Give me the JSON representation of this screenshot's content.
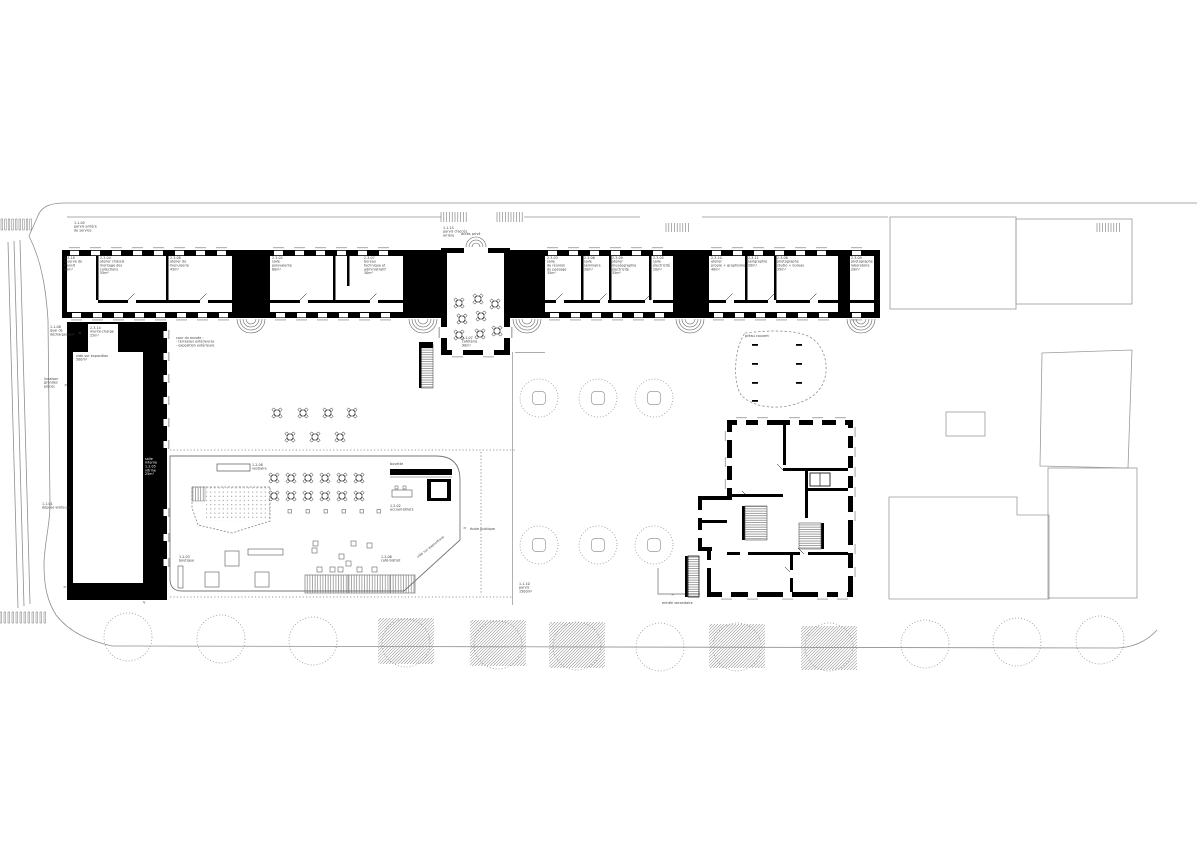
{
  "colors": {
    "ink": "#000000",
    "siteline": "#8f8f8f",
    "label": "#3a3a3a",
    "sill": "#b5b5b5"
  },
  "labels": {
    "parvis_arriere": "1.1.05\nparvis arrière\nde service",
    "acces_arriere": "1.1.14\nparvis d'accès\narrière",
    "acces_prive": "accès privé",
    "quai": "1.1.08\nquai de\ndéchargement",
    "monte_charge": "2.3.14\nmonte-charge\n25m²",
    "vide_expo": "vide sur exposition\n500m²",
    "livraison": "livraison\ngrandes\npièces",
    "depose": "1.1.01\ndépose-visiteurs",
    "galerie": "salle\ninterne\n1.2.05\nvitrine\n25m²",
    "cour": "cour du musée :\n- terrasses extérieures\n- exposition extérieure",
    "cafeteria": "2.1.07\ncafétéria\n90m²",
    "vestiaire": "1.2.08\nvestiaire",
    "buvette": "buvette",
    "accueil": "1.2.02\naccueil-billets",
    "boutique": "1.2.03\nboutique",
    "cafe_bistrot": "1.2.06\ncafé-bistrot",
    "vide_expos2": "vide sur expositions",
    "ecole": "école publique",
    "parvis": "1.1.10\nparvis\n1500m²",
    "entree_sec": "entrée secondaire",
    "preau": "préau couvert"
  },
  "arrows": {
    "right": ">",
    "left": "<",
    "up": "^",
    "down": "v"
  },
  "rooms": [
    "2.3.18\nréserve de\ntransit\n30m²",
    "2.3.04\natelier châssis\nmontage des\ncollections\n55m²",
    "2.3.08\natelier de\nmenuiserie\n45m²",
    "2.3.02\nsalle\npolyvalente\n60m²",
    "2.3.07\nbureau\ntechnique et\nadministratif\n30m²",
    "2.3.03\nsalle\nde réunion\ndu passage\n35m²",
    "2.3.06\nsalle\nséminaire\n20m²",
    "2.3.09\natelier\nmuséographie\nélectricité\n35m²",
    "2.3.05\nsalle\nélectricité\n20m²",
    "2.3.10\natelier\npropre + graphisme\n40m²",
    "2.3.11\nsérigraphie\n20m²",
    "2.3.08\nphotographe\nstudio + bureau\n35m²",
    "2.3.09\nphotographe\nlaboratoire\n20m²"
  ]
}
